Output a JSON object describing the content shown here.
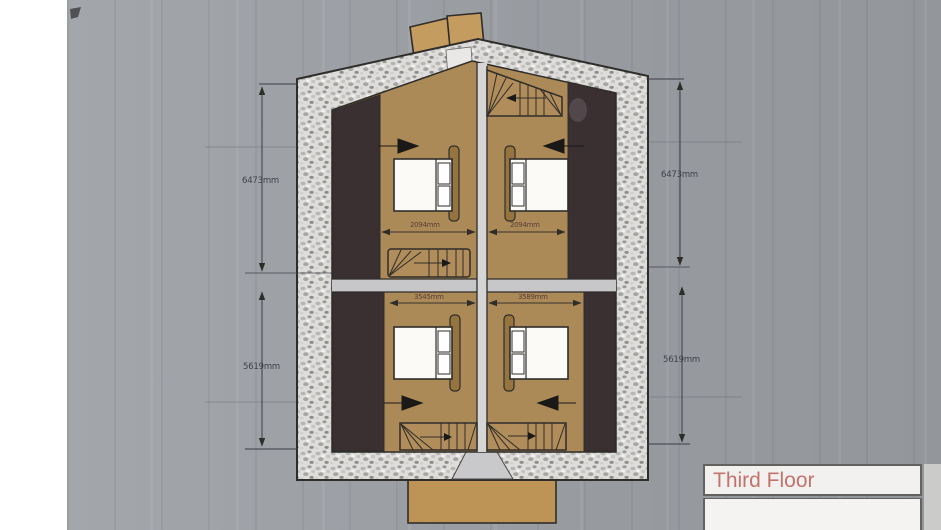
{
  "title_block": {
    "title": "Third Floor",
    "title_color": "#c4736c"
  },
  "plan": {
    "dimensions": {
      "left_upper": "6473mm",
      "left_lower": "5619mm",
      "right_upper": "6473mm",
      "right_lower": "5619mm",
      "upper_left_room_width": "2094mm",
      "upper_right_room_width": "2094mm",
      "lower_left_room_width": "3545mm",
      "lower_right_room_width": "3589mm"
    },
    "colors": {
      "background_gray": "#9ea2a7",
      "floor_tan": "#ab8a58",
      "eaves_dark_brown": "#3a2f31",
      "stone_wall": "#dedddb",
      "chimney_tan": "#c49c60",
      "outline": "#2f2d2a"
    }
  }
}
